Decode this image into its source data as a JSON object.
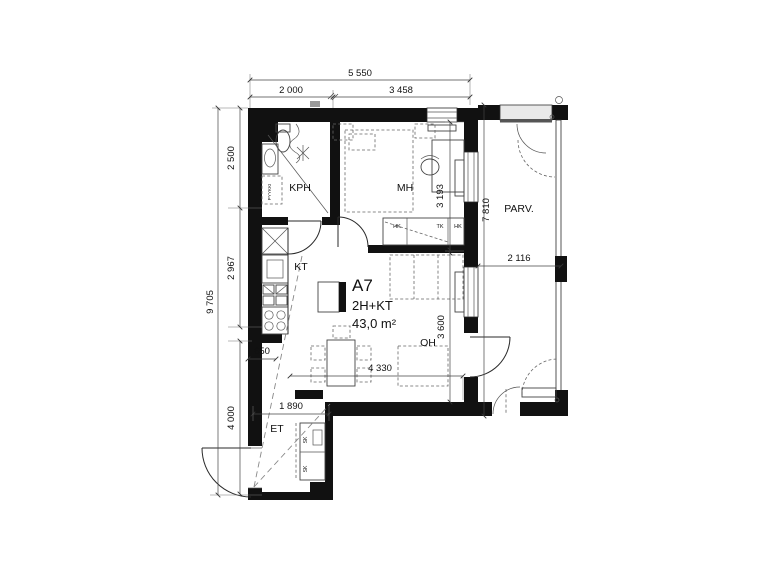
{
  "unit": {
    "code": "A7",
    "layout": "2H+KT",
    "area": "43,0 m²"
  },
  "rooms": {
    "bathroom": "KPH",
    "bedroom": "MH",
    "kitchen": "KT",
    "living_room": "OH",
    "entry": "ET",
    "balcony": "PARV."
  },
  "fixtures": {
    "laundry": "PYYKKI",
    "wardrobe_1": "HK",
    "wardrobe_2": "TK",
    "wardrobe_3": "HK",
    "closet_1": "SK",
    "closet_2": "SK"
  },
  "dimensions": {
    "top_total": "5 550",
    "top_left": "2 000",
    "top_right": "3 458",
    "left_total": "9 705",
    "left_upper": "2 500",
    "left_middle": "2 967",
    "left_lower": "4 000",
    "counter_depth": "650",
    "entry_width": "1 890",
    "bedroom_depth": "3 193",
    "living_depth": "3 600",
    "living_width": "4 330",
    "balcony_depth": "7 810",
    "balcony_width": "2 116"
  },
  "colors": {
    "wall": "#111111",
    "line": "#2a2a2a",
    "dashed": "#888888",
    "background": "#ffffff",
    "glazing": "#e9e9e9"
  }
}
